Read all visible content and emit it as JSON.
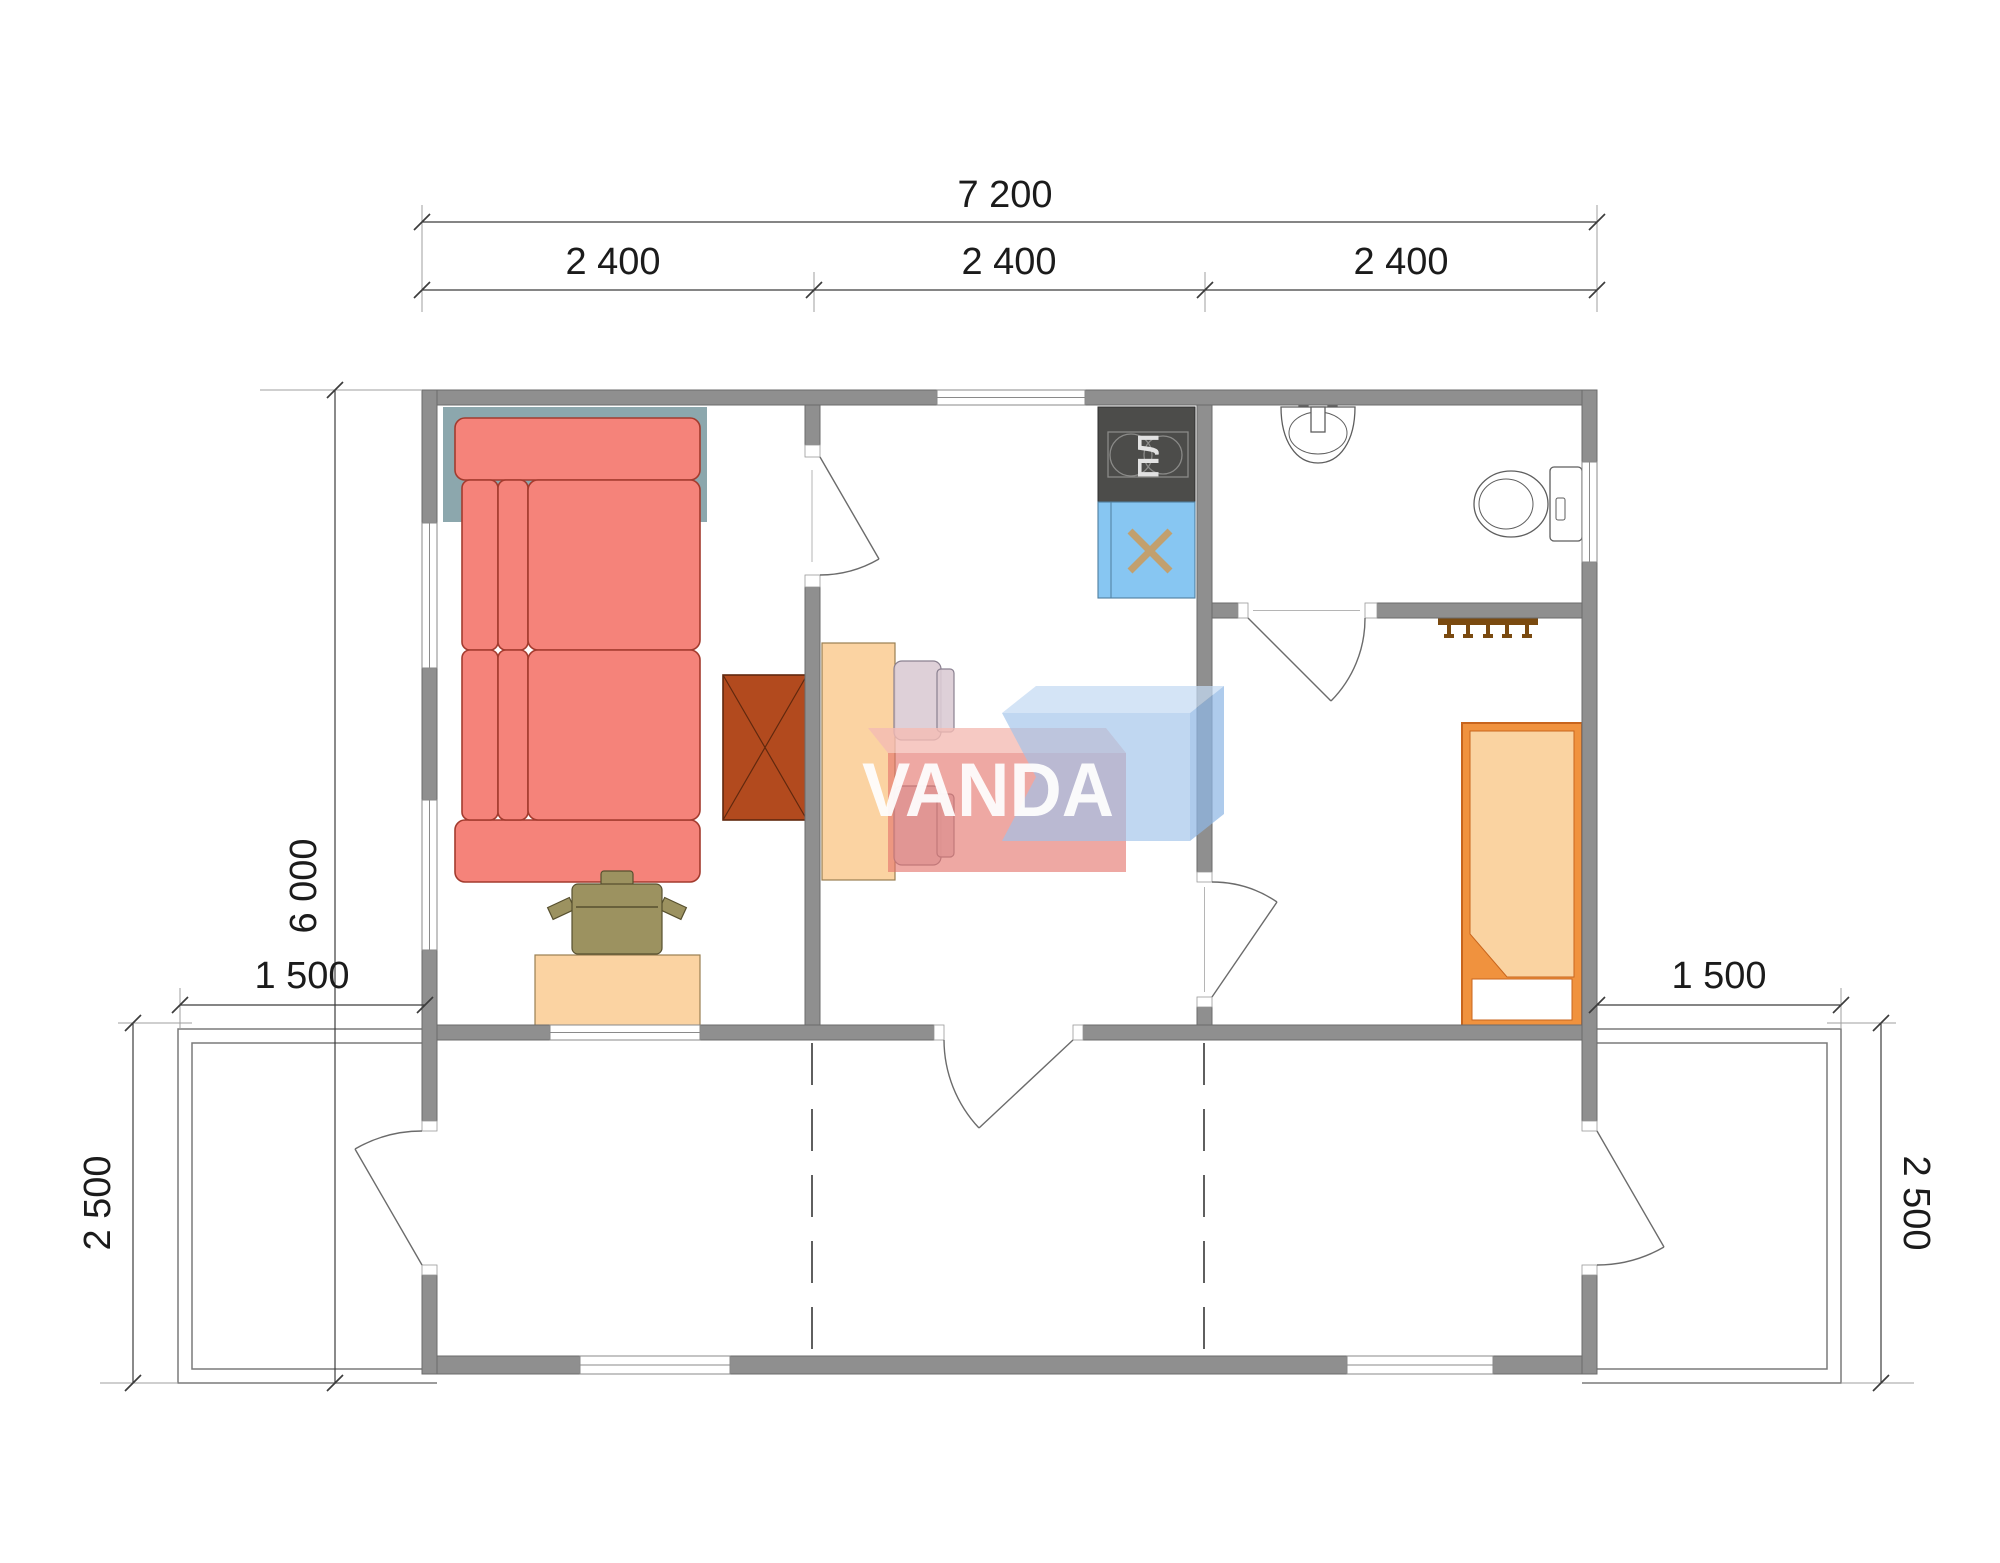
{
  "palette": {
    "wall_fill": "#8f8f8f",
    "wall_edge": "#6b6b6b",
    "dim_color": "#3c3c3c",
    "accent_teal": "#8ca7ad",
    "sofa_fill": "#f5837a",
    "sofa_edge": "#a33b2e",
    "wardrobe_fill": "#b24a1e",
    "wardrobe_edge": "#60280e",
    "table_fill": "#fbd3a2",
    "table_edge": "#9a7f52",
    "chair_fill": "#dacbd4",
    "chair_edge": "#8a8090",
    "desk_chair_fill": "#9c9260",
    "desk_chair_edge": "#57502f",
    "bed_frame": "#f0923e",
    "bed_edge": "#c8651d",
    "bed_blanket": "#fad3a1",
    "stove_fill": "#4c4c4a",
    "stove_detail": "#8a8a88",
    "sink_fill": "#87c6f2",
    "sink_edge": "#4f7f9f",
    "sink_x": "#c2a06e",
    "rack_fill": "#7a4a10",
    "wm_red": "#e4736b",
    "wm_red_top": "#f4bcb4",
    "wm_blue": "#9fc3ea",
    "wm_blue_top": "#c3d9f2",
    "wm_blue_side": "#8fb7e4",
    "wm_text": "#ffffff"
  },
  "dimensions": {
    "top_total": "7 200",
    "top_segments": [
      "2 400",
      "2 400",
      "2 400"
    ],
    "left_depth": "6 000",
    "deck_left": {
      "width": "1 500",
      "depth": "2 500"
    },
    "deck_right": {
      "width": "1 500",
      "depth": "2 500"
    }
  },
  "watermark": {
    "text": "VANDA"
  },
  "kitchen": {
    "stove_label": "ПЛ"
  }
}
